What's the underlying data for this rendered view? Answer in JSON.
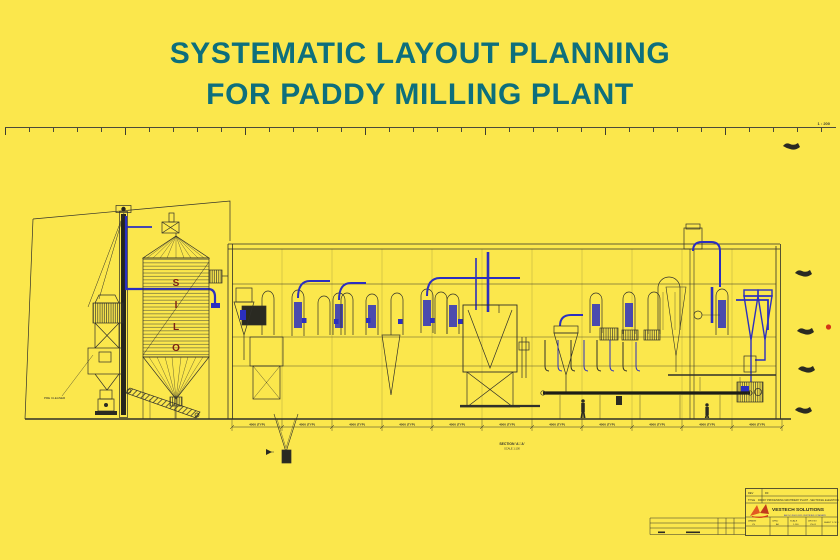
{
  "colors": {
    "background": "#fbe74c",
    "title_text": "#0d6f7c",
    "line_dark": "#30302a",
    "pipe_blue": "#2b2fc0",
    "silo_letter": "#7c2013",
    "marker_red": "#d43418",
    "logo_orange": "#e25822"
  },
  "title": {
    "line1": "SYSTEMATIC LAYOUT PLANNING",
    "line2": "FOR PADDY MILLING PLANT"
  },
  "ruler": {
    "note": "1 : 200"
  },
  "drawing": {
    "silo_letters": [
      "S",
      "I",
      "L",
      "O"
    ],
    "dimension_label": "4000 (TYP)",
    "section_label": "SECTION 'A'-'A'",
    "section_scale": "SCALE 1:100",
    "left_machine_label": "PRE CLEANER"
  },
  "title_block": {
    "revision_label": "REV",
    "revision_value": "R0",
    "title_label": "TITLE",
    "drawing_title": "PADDY PROCESSING MACHINERY PLANT - SECTIONAL ELEVATION",
    "company": "VESTECH SOLUTIONS",
    "tagline": "AN ISO 9001:2015 CERTIFIED COMPANY",
    "fields": [
      {
        "label": "DRAWN",
        "value": "VS"
      },
      {
        "label": "CHKD",
        "value": "AK"
      },
      {
        "label": "SCALE",
        "value": "1:100"
      },
      {
        "label": "DRG NO",
        "value": "VS-01"
      }
    ],
    "sheet": "SHEET 1 OF 1"
  }
}
